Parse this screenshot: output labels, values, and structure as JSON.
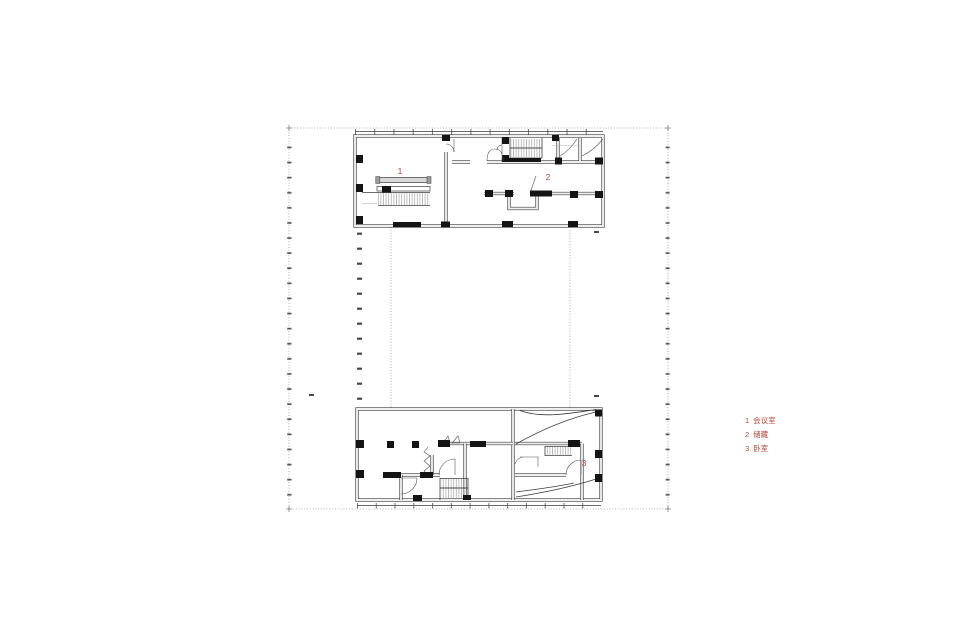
{
  "colors": {
    "accent": "#b5453e",
    "line": "#3d3d3d",
    "muted": "#9a9a9a",
    "background": "#ffffff"
  },
  "plan": {
    "type": "architectural-floor-plan",
    "room_labels": [
      {
        "id": "1"
      },
      {
        "id": "2"
      },
      {
        "id": "3"
      }
    ],
    "legend": {
      "items": [
        {
          "num": "1",
          "label": "会议室"
        },
        {
          "num": "2",
          "label": "储藏"
        },
        {
          "num": "3",
          "label": "卧室"
        }
      ]
    }
  }
}
